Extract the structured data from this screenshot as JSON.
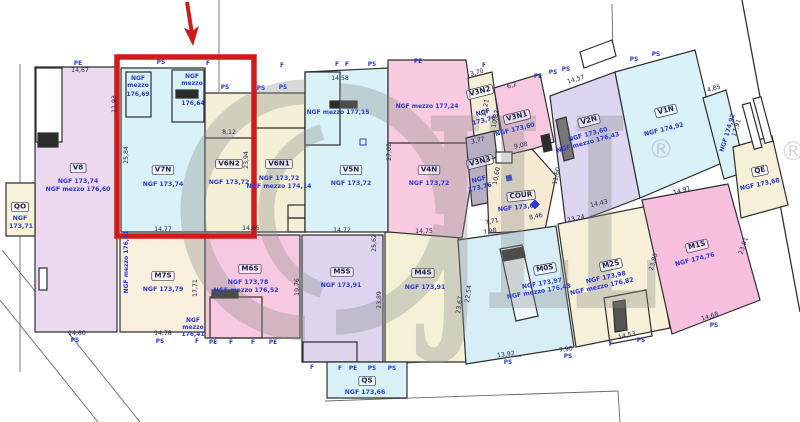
{
  "watermark": {
    "brand": "JLL",
    "registered": "®",
    "color": "#8b8b8b"
  },
  "highlight": {
    "color": "#cf1b1b"
  },
  "units": [
    {
      "id": "v8",
      "tag": "V8",
      "x": 78,
      "y": 168,
      "r": 0,
      "lines": [
        {
          "t": "NGF 173,74",
          "x": 78,
          "y": 182
        },
        {
          "t": "NGF mezzo 176,60",
          "x": 78,
          "y": 190
        }
      ]
    },
    {
      "id": "qo",
      "tag": "QO",
      "x": 20,
      "y": 207,
      "r": 0,
      "lines": [
        {
          "t": "NGF",
          "x": 20,
          "y": 219
        },
        {
          "t": "173,71",
          "x": 21,
          "y": 227
        }
      ]
    },
    {
      "id": "v7n",
      "tag": "V7N",
      "x": 163,
      "y": 170,
      "r": 0,
      "lines": [
        {
          "t": "NGF 173,74",
          "x": 163,
          "y": 185
        }
      ]
    },
    {
      "id": "v6n2",
      "tag": "V6N2",
      "x": 229,
      "y": 164,
      "r": 0,
      "lines": [
        {
          "t": "NGF 173,72",
          "x": 229,
          "y": 183
        }
      ]
    },
    {
      "id": "v6n1",
      "tag": "V6N1",
      "x": 279,
      "y": 164,
      "r": 0,
      "lines": [
        {
          "t": "NGF 173,72",
          "x": 279,
          "y": 179
        },
        {
          "t": "NGF mezzo 174,14",
          "x": 279,
          "y": 187
        }
      ]
    },
    {
      "id": "v5n",
      "tag": "V5N",
      "x": 351,
      "y": 170,
      "r": 0,
      "lines": [
        {
          "t": "NGF 173,72",
          "x": 351,
          "y": 184
        }
      ]
    },
    {
      "id": "v4n",
      "tag": "V4N",
      "x": 429,
      "y": 170,
      "r": 0,
      "lines": [
        {
          "t": "NGF 173,72",
          "x": 429,
          "y": 184
        }
      ]
    },
    {
      "id": "v3n2",
      "tag": "V3N2",
      "x": 480,
      "y": 92,
      "r": -14,
      "lines": [
        {
          "t": "NGF",
          "x": 483,
          "y": 113
        },
        {
          "t": "173,76",
          "x": 484,
          "y": 121
        }
      ]
    },
    {
      "id": "v3n1",
      "tag": "V3N1",
      "x": 517,
      "y": 117,
      "r": -14,
      "lines": [
        {
          "t": "NGF 173,60",
          "x": 515,
          "y": 130
        }
      ]
    },
    {
      "id": "v3n3",
      "tag": "V3N3",
      "x": 480,
      "y": 162,
      "r": -14,
      "lines": [
        {
          "t": "NGF",
          "x": 479,
          "y": 180
        },
        {
          "t": "173,76",
          "x": 480,
          "y": 188
        }
      ]
    },
    {
      "id": "v2n",
      "tag": "V2N",
      "x": 589,
      "y": 121,
      "r": -15,
      "lines": [
        {
          "t": "NGF 173,60",
          "x": 588,
          "y": 135
        },
        {
          "t": "NGF mezzo 176,43",
          "x": 588,
          "y": 143
        }
      ]
    },
    {
      "id": "v1n",
      "tag": "V1N",
      "x": 666,
      "y": 111,
      "r": -14,
      "lines": [
        {
          "t": "NGF 174,92",
          "x": 664,
          "y": 130
        }
      ]
    },
    {
      "id": "qe",
      "tag": "QE",
      "x": 760,
      "y": 171,
      "r": -12,
      "lines": [
        {
          "t": "NGF 173,68",
          "x": 760,
          "y": 185
        }
      ]
    },
    {
      "id": "cour",
      "tag": "COUR",
      "x": 521,
      "y": 196,
      "r": -6,
      "lines": [
        {
          "t": "NGF 173,68",
          "x": 518,
          "y": 208
        }
      ]
    },
    {
      "id": "m7s",
      "tag": "M7S",
      "x": 163,
      "y": 276,
      "r": 0,
      "lines": [
        {
          "t": "NGF 173,79",
          "x": 163,
          "y": 290
        }
      ]
    },
    {
      "id": "m6s",
      "tag": "M6S",
      "x": 250,
      "y": 269,
      "r": 0,
      "lines": [
        {
          "t": "NGF 173,78",
          "x": 248,
          "y": 283
        },
        {
          "t": "NGF mezzo 176,52",
          "x": 246,
          "y": 291
        }
      ]
    },
    {
      "id": "m5s",
      "tag": "M5S",
      "x": 342,
      "y": 272,
      "r": 0,
      "lines": [
        {
          "t": "NGF 173,91",
          "x": 341,
          "y": 286
        }
      ]
    },
    {
      "id": "m4s",
      "tag": "M4S",
      "x": 423,
      "y": 273,
      "r": 0,
      "lines": [
        {
          "t": "NGF 173,91",
          "x": 425,
          "y": 288
        }
      ]
    },
    {
      "id": "m0s",
      "tag": "M0S",
      "x": 545,
      "y": 269,
      "r": -10,
      "lines": [
        {
          "t": "NGF 173,97",
          "x": 542,
          "y": 284
        },
        {
          "t": "NGF mezzo 176,43",
          "x": 539,
          "y": 292
        }
      ]
    },
    {
      "id": "m2s",
      "tag": "M2S",
      "x": 611,
      "y": 265,
      "r": -12,
      "lines": [
        {
          "t": "NGF 173,98",
          "x": 606,
          "y": 278
        },
        {
          "t": "NGF mezzo 176,82",
          "x": 602,
          "y": 287
        }
      ]
    },
    {
      "id": "m1s",
      "tag": "M1S",
      "x": 697,
      "y": 246,
      "r": -14,
      "lines": [
        {
          "t": "NGF 174,76",
          "x": 695,
          "y": 260
        }
      ]
    },
    {
      "id": "qs",
      "tag": "QS",
      "x": 367,
      "y": 381,
      "r": 0,
      "lines": [
        {
          "t": "NGF 173,66",
          "x": 365,
          "y": 393
        }
      ]
    }
  ],
  "small_labels": [
    {
      "t": "NGF",
      "x": 138,
      "y": 79,
      "r": 0
    },
    {
      "t": "mezzo",
      "x": 138,
      "y": 86,
      "r": 0
    },
    {
      "t": "176,69",
      "x": 138,
      "y": 95,
      "r": 0
    },
    {
      "t": "NGF",
      "x": 192,
      "y": 77,
      "r": 0
    },
    {
      "t": "mezzo",
      "x": 192,
      "y": 84,
      "r": 0
    },
    {
      "t": "176,64",
      "x": 193,
      "y": 104,
      "r": 0
    },
    {
      "t": "NGF",
      "x": 193,
      "y": 321,
      "r": 0
    },
    {
      "t": "mezzo",
      "x": 193,
      "y": 328,
      "r": 0
    },
    {
      "t": "176,41",
      "x": 193,
      "y": 335,
      "r": 0
    },
    {
      "t": "NGF mezzo 176,41",
      "x": 127,
      "y": 262,
      "r": -90
    },
    {
      "t": "NGF mezzo 177,15",
      "x": 338,
      "y": 113,
      "r": 0
    },
    {
      "t": "NGF mezzo 177,24",
      "x": 427,
      "y": 107,
      "r": 0
    },
    {
      "t": "NGF 174,92",
      "x": 728,
      "y": 133,
      "r": -73
    }
  ],
  "dims": [
    {
      "t": "14,67",
      "x": 80,
      "y": 71,
      "r": 0
    },
    {
      "t": "8,12",
      "x": 229,
      "y": 133,
      "r": 0
    },
    {
      "t": "14,58",
      "x": 340,
      "y": 79,
      "r": 0
    },
    {
      "t": "14,77",
      "x": 163,
      "y": 230,
      "r": 0
    },
    {
      "t": "14,65",
      "x": 251,
      "y": 229,
      "r": 0
    },
    {
      "t": "14,72",
      "x": 342,
      "y": 231,
      "r": 0
    },
    {
      "t": "14,75",
      "x": 424,
      "y": 232,
      "r": 0
    },
    {
      "t": "14,80",
      "x": 77,
      "y": 334,
      "r": 0
    },
    {
      "t": "14,78",
      "x": 163,
      "y": 334,
      "r": 0
    },
    {
      "t": "25,84",
      "x": 127,
      "y": 155,
      "r": -90
    },
    {
      "t": "11,93",
      "x": 115,
      "y": 104,
      "r": -90
    },
    {
      "t": "23,94",
      "x": 247,
      "y": 160,
      "r": -90
    },
    {
      "t": "27,02",
      "x": 390,
      "y": 152,
      "r": -90
    },
    {
      "t": "19,76",
      "x": 298,
      "y": 287,
      "r": -90
    },
    {
      "t": "17,71",
      "x": 196,
      "y": 288,
      "r": -90
    },
    {
      "t": "23,89",
      "x": 380,
      "y": 300,
      "r": -90
    },
    {
      "t": "25,62",
      "x": 375,
      "y": 243,
      "r": -90
    },
    {
      "t": "22,54",
      "x": 469,
      "y": 294,
      "r": -82
    },
    {
      "t": "23,67",
      "x": 460,
      "y": 305,
      "r": -82
    },
    {
      "t": "10,60",
      "x": 497,
      "y": 176,
      "r": -80
    },
    {
      "t": "11,60",
      "x": 557,
      "y": 176,
      "r": -78
    },
    {
      "t": "11,21",
      "x": 486,
      "y": 108,
      "r": -80
    },
    {
      "t": "10,82",
      "x": 496,
      "y": 119,
      "r": -80
    },
    {
      "t": "17,91",
      "x": 737,
      "y": 128,
      "r": -73
    },
    {
      "t": "23,80",
      "x": 654,
      "y": 262,
      "r": -74
    },
    {
      "t": "23,91",
      "x": 744,
      "y": 246,
      "r": -72
    },
    {
      "t": "3,70",
      "x": 477,
      "y": 73,
      "r": -15
    },
    {
      "t": "6,2",
      "x": 512,
      "y": 86,
      "r": -17
    },
    {
      "t": "9,08",
      "x": 521,
      "y": 146,
      "r": -13
    },
    {
      "t": "3,77",
      "x": 478,
      "y": 141,
      "r": -13
    },
    {
      "t": "14,57",
      "x": 576,
      "y": 80,
      "r": -17
    },
    {
      "t": "4,85",
      "x": 714,
      "y": 89,
      "r": -16
    },
    {
      "t": "14,91",
      "x": 682,
      "y": 191,
      "r": -16
    },
    {
      "t": "14,43",
      "x": 599,
      "y": 204,
      "r": -13
    },
    {
      "t": "23,24",
      "x": 576,
      "y": 219,
      "r": -13
    },
    {
      "t": "8,46",
      "x": 536,
      "y": 217,
      "r": -12
    },
    {
      "t": "7,71",
      "x": 492,
      "y": 222,
      "r": -12
    },
    {
      "t": "7,98",
      "x": 490,
      "y": 232,
      "r": -12
    },
    {
      "t": "13,92",
      "x": 506,
      "y": 355,
      "r": -8
    },
    {
      "t": "7,90",
      "x": 566,
      "y": 350,
      "r": -10
    },
    {
      "t": "14,53",
      "x": 627,
      "y": 336,
      "r": -13
    },
    {
      "t": "14,68",
      "x": 710,
      "y": 317,
      "r": -17
    }
  ],
  "marks": [
    {
      "t": "PE",
      "x": 78,
      "y": 64
    },
    {
      "t": "PS",
      "x": 161,
      "y": 63
    },
    {
      "t": "F",
      "x": 208,
      "y": 64
    },
    {
      "t": "F",
      "x": 282,
      "y": 66
    },
    {
      "t": "F",
      "x": 337,
      "y": 65
    },
    {
      "t": "F",
      "x": 347,
      "y": 65
    },
    {
      "t": "PS",
      "x": 372,
      "y": 65
    },
    {
      "t": "PE",
      "x": 418,
      "y": 62
    },
    {
      "t": "PS",
      "x": 225,
      "y": 88
    },
    {
      "t": "PS",
      "x": 261,
      "y": 89
    },
    {
      "t": "PS",
      "x": 283,
      "y": 88
    },
    {
      "t": "F",
      "x": 484,
      "y": 66
    },
    {
      "t": "PE",
      "x": 538,
      "y": 77
    },
    {
      "t": "PS",
      "x": 553,
      "y": 73
    },
    {
      "t": "PS",
      "x": 566,
      "y": 70
    },
    {
      "t": "PS",
      "x": 634,
      "y": 60
    },
    {
      "t": "PS",
      "x": 656,
      "y": 55
    },
    {
      "t": "PS",
      "x": 75,
      "y": 341
    },
    {
      "t": "PS",
      "x": 160,
      "y": 342
    },
    {
      "t": "F",
      "x": 197,
      "y": 342
    },
    {
      "t": "PE",
      "x": 213,
      "y": 343
    },
    {
      "t": "F",
      "x": 231,
      "y": 343
    },
    {
      "t": "F",
      "x": 253,
      "y": 343
    },
    {
      "t": "PE",
      "x": 273,
      "y": 343
    },
    {
      "t": "F",
      "x": 312,
      "y": 368
    },
    {
      "t": "F",
      "x": 340,
      "y": 369
    },
    {
      "t": "PE",
      "x": 353,
      "y": 369
    },
    {
      "t": "PS",
      "x": 372,
      "y": 369
    },
    {
      "t": "PS",
      "x": 392,
      "y": 369
    },
    {
      "t": "PS",
      "x": 508,
      "y": 363
    },
    {
      "t": "PS",
      "x": 568,
      "y": 357
    },
    {
      "t": "F",
      "x": 611,
      "y": 345
    },
    {
      "t": "PS",
      "x": 641,
      "y": 341
    },
    {
      "t": "PS",
      "x": 714,
      "y": 326
    }
  ]
}
